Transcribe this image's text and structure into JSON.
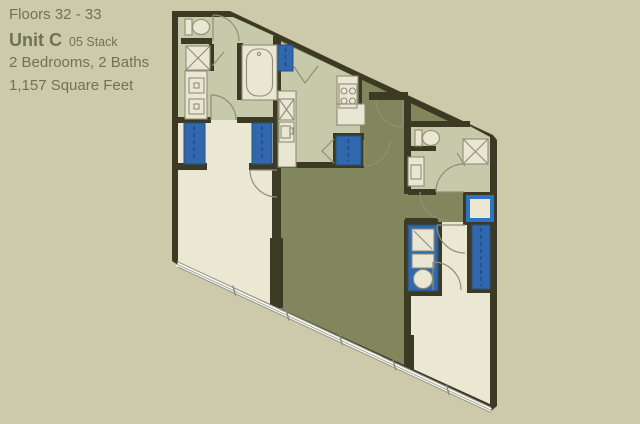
{
  "header": {
    "floors": "Floors 32 - 33",
    "unit_name": "Unit C",
    "stack": "05 Stack",
    "beds_baths": "2  Bedrooms, 2 Baths",
    "square_feet": "1,157 Square Feet"
  },
  "palette": {
    "bg": "#cdc9ab",
    "text": "#6f7356",
    "wall": "#3d3a23",
    "cream": "#eae7d2",
    "sage": "#c7c9ab",
    "olive": "#81865d",
    "blue": "#3167ad",
    "blueDark": "#27517f",
    "blueBright": "#2e74c4",
    "blueDash": "#1f4a86",
    "fixture": "#e9e7d4",
    "fixtureStroke": "#8e8e76",
    "arc": "#8f9078",
    "window": "#fafaf2",
    "windowEdge": "#96968a"
  },
  "plan": {
    "rooms": [
      {
        "name": "bathroom-1",
        "floor": "sage"
      },
      {
        "name": "bedroom-1",
        "floor": "cream"
      },
      {
        "name": "kitchen",
        "floor": "sage"
      },
      {
        "name": "living-dining",
        "floor": "olive"
      },
      {
        "name": "foyer",
        "floor": "olive"
      },
      {
        "name": "bathroom-2",
        "floor": "sage"
      },
      {
        "name": "bedroom-2",
        "floor": "cream"
      }
    ],
    "fixtures": [
      "toilet",
      "shower",
      "double-vanity",
      "bathtub",
      "refrigerator",
      "kitchen-sink",
      "range-4-burner",
      "pantry-closet",
      "entry-door",
      "closet",
      "washer-dryer-stack",
      "linen-closet",
      "window-wall"
    ]
  }
}
